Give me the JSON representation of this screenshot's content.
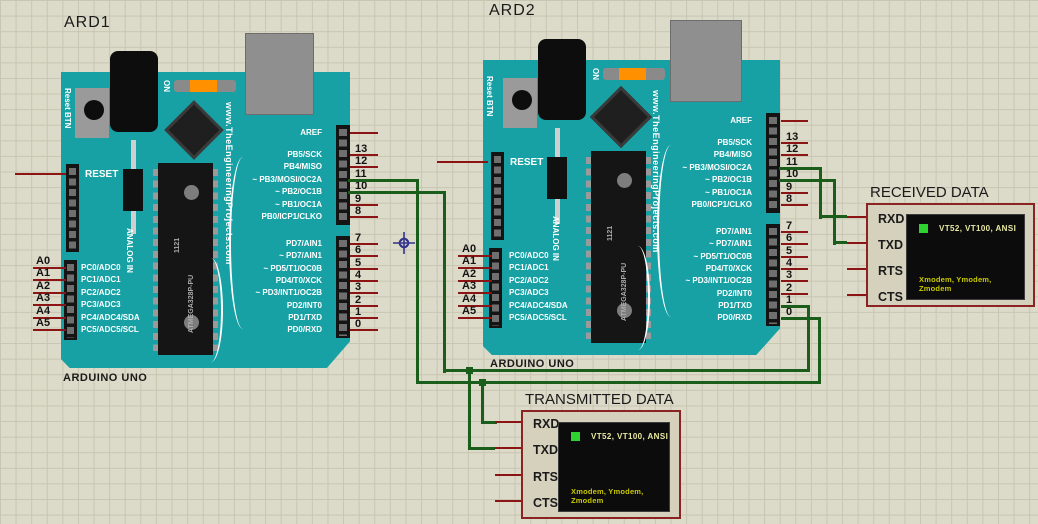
{
  "window": {
    "width": 1038,
    "height": 524
  },
  "boards": [
    {
      "title": "ARD1",
      "subtitle": "ARDUINO UNO"
    },
    {
      "title": "ARD2",
      "subtitle": "ARDUINO UNO"
    }
  ],
  "board_common": {
    "brand": "www.TheEngineeringProjects.com",
    "chip": "ATMEGA328P-PU",
    "chip_code": "1121",
    "reset_btn": "Reset BTN",
    "on": "ON",
    "reset": "RESET",
    "analog_in": "ANALOG IN",
    "aref": "AREF",
    "right_top": [
      "PB5/SCK",
      "PB4/MISO",
      "~ PB3/MOSI/OC2A",
      "~ PB2/OC1B",
      "~ PB1/OC1A",
      "PB0/ICP1/CLKO"
    ],
    "right_bottom": [
      "PD7/AIN1",
      "~ PD7/AIN1",
      "~ PD5/T1/OC0B",
      "PD4/T0/XCK",
      "~ PD3/INT1/OC2B",
      "PD2/INT0",
      "PD1/TXD",
      "PD0/RXD"
    ],
    "left_analog": [
      "PC0/ADC0",
      "PC1/ADC1",
      "PC2/ADC2",
      "PC3/ADC3",
      "PC4/ADC4/SDA",
      "PC5/ADC5/SCL"
    ],
    "pin_numbers_top": [
      "13",
      "12",
      "11",
      "10",
      "9",
      "8"
    ],
    "pin_numbers_bottom": [
      "7",
      "6",
      "5",
      "4",
      "3",
      "2",
      "1",
      "0"
    ],
    "analog_names": [
      "A0",
      "A1",
      "A2",
      "A3",
      "A4",
      "A5"
    ]
  },
  "terminals": [
    {
      "title": "RECEIVED DATA",
      "pins": [
        "RXD",
        "TXD",
        "RTS",
        "CTS"
      ],
      "screen_top": "VT52, VT100, ANSI",
      "screen_bottom": "Xmodem, Ymodem, Zmodem"
    },
    {
      "title": "TRANSMITTED DATA",
      "pins": [
        "RXD",
        "TXD",
        "RTS",
        "CTS"
      ],
      "screen_top": "VT52, VT100, ANSI",
      "screen_bottom": "Xmodem, Ymodem, Zmodem"
    }
  ],
  "colors": {
    "board_teal": "#17a1a4",
    "wire_green": "#1b5e1b",
    "pin_red": "#8d1414",
    "terminal_border": "#8b2323",
    "terminal_bg": "#d6d1bd",
    "screen_bg": "#0c0c0c",
    "screen_text_top": "#e9e9a4",
    "screen_text_bottom": "#c9c900",
    "led_green": "#2fd32f",
    "grid_bg": "#dcdac8",
    "grid_line": "#c8c6b2",
    "orange_led": "#ff9100"
  }
}
